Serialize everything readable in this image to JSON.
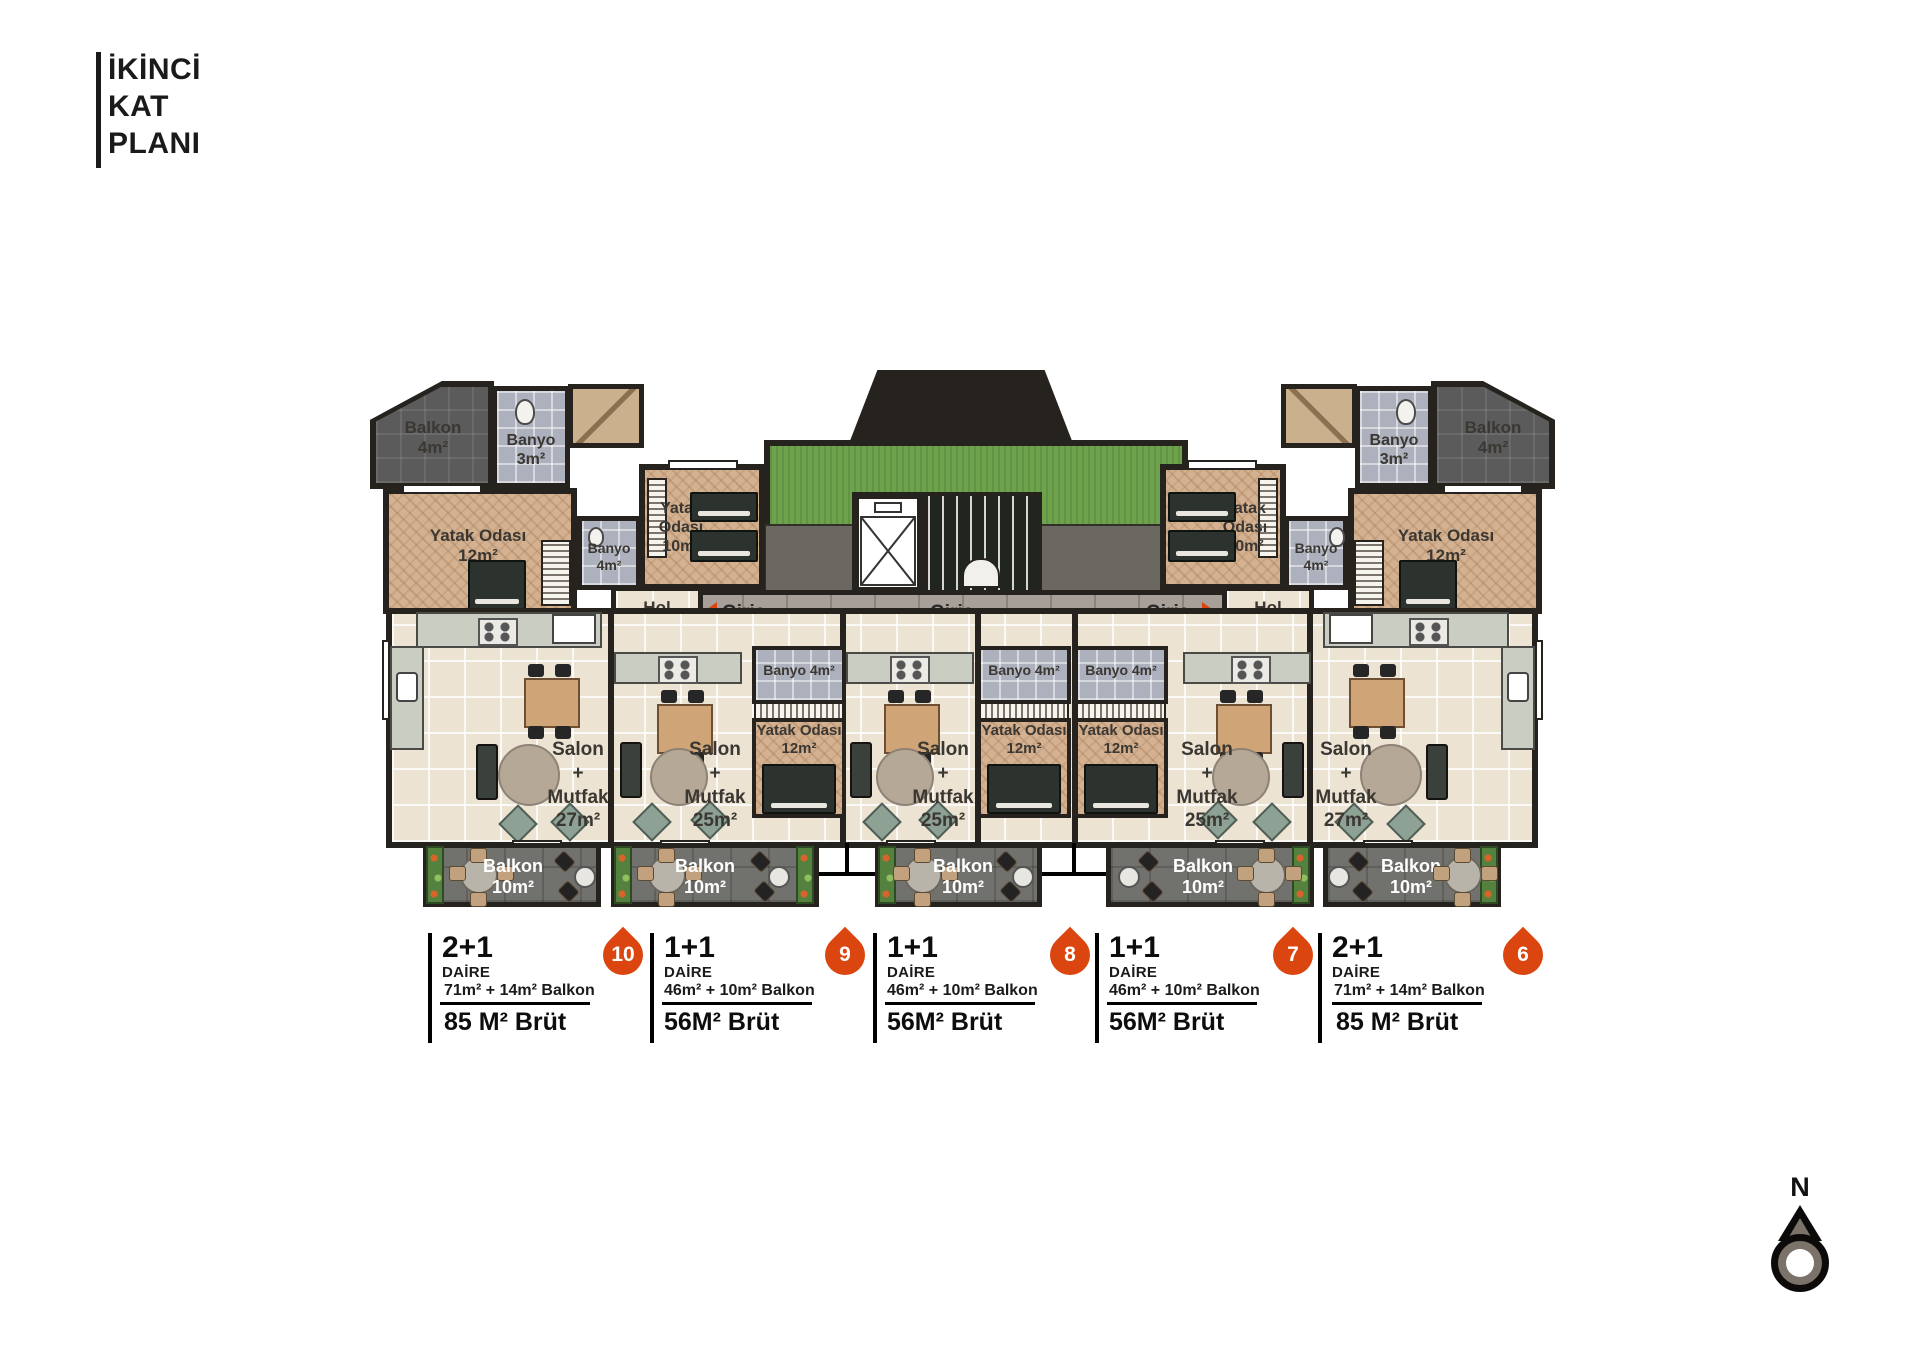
{
  "title_block": {
    "lines": [
      "İKİNCİ",
      "KAT",
      "PLANI"
    ]
  },
  "plan": {
    "entrance_labels": [
      "Giriş",
      "Giriş",
      "Giriş"
    ],
    "unit_10": {
      "balkon_top": {
        "name": "Balkon",
        "area": "4m²"
      },
      "banyo_top": {
        "name": "Banyo",
        "area": "3m²"
      },
      "yatak_master": {
        "name": "Yatak Odası",
        "area": "12m²"
      },
      "banyo": {
        "name": "Banyo",
        "area": "4m²"
      },
      "yatak_second": {
        "name": "Yatak Odası",
        "area": "10m²"
      },
      "hol": {
        "name": "Hol",
        "area": "4m²"
      },
      "salon": {
        "line1": "Salon",
        "line2": "+",
        "line3": "Mutfak",
        "line4": "27m²"
      },
      "balkon": {
        "name": "Balkon",
        "area": "10m²"
      }
    },
    "unit_9": {
      "banyo": "Banyo 4m²",
      "yatak": {
        "name": "Yatak Odası",
        "area": "12m²"
      },
      "salon": {
        "line1": "Salon",
        "line2": "+",
        "line3": "Mutfak",
        "line4": "25m²"
      },
      "balkon": {
        "name": "Balkon",
        "area": "10m²"
      }
    },
    "unit_8": {
      "banyo": "Banyo 4m²",
      "yatak": {
        "name": "Yatak Odası",
        "area": "12m²"
      },
      "salon": {
        "line1": "Salon",
        "line2": "+",
        "line3": "Mutfak",
        "line4": "25m²"
      },
      "balkon": {
        "name": "Balkon",
        "area": "10m²"
      }
    },
    "unit_7": {
      "banyo": "Banyo 4m²",
      "yatak": {
        "name": "Yatak Odası",
        "area": "12m²"
      },
      "salon": {
        "line1": "Salon",
        "line2": "+",
        "line3": "Mutfak",
        "line4": "25m²"
      },
      "balkon": {
        "name": "Balkon",
        "area": "10m²"
      }
    },
    "unit_6": {
      "balkon_top": {
        "name": "Balkon",
        "area": "4m²"
      },
      "banyo_top": {
        "name": "Banyo",
        "area": "3m²"
      },
      "yatak_master": {
        "name": "Yatak Odası",
        "area": "12m²"
      },
      "banyo": {
        "name": "Banyo",
        "area": "4m²"
      },
      "yatak_second": {
        "name": "Yatak Odası",
        "area": "10m²"
      },
      "hol": {
        "name": "Hol",
        "area": "4m²"
      },
      "salon": {
        "line1": "Salon",
        "line2": "+",
        "line3": "Mutfak",
        "line4": "27m²"
      },
      "balkon": {
        "name": "Balkon",
        "area": "10m²"
      }
    },
    "compass": {
      "north": "N"
    }
  },
  "legend": {
    "entries": [
      {
        "badge": "10",
        "type": "2+1",
        "category": "DAİRE",
        "area_detail": "71m² + 14m² Balkon",
        "gross_area": "85 M² Brüt"
      },
      {
        "badge": "9",
        "type": "1+1",
        "category": "DAİRE",
        "area_detail": "46m² + 10m² Balkon",
        "gross_area": "56M² Brüt"
      },
      {
        "badge": "8",
        "type": "1+1",
        "category": "DAİRE",
        "area_detail": "46m² + 10m² Balkon",
        "gross_area": "56M² Brüt"
      },
      {
        "badge": "7",
        "type": "1+1",
        "category": "DAİRE",
        "area_detail": "46m² + 10m² Balkon",
        "gross_area": "56M² Brüt"
      },
      {
        "badge": "6",
        "type": "2+1",
        "category": "DAİRE",
        "area_detail": "71m² + 14m² Balkon",
        "gross_area": "85 M² Brüt"
      }
    ]
  },
  "colors": {
    "accent_orange": "#db450f",
    "wall_dark": "#26221e",
    "grass_green": "#6fa24d"
  }
}
